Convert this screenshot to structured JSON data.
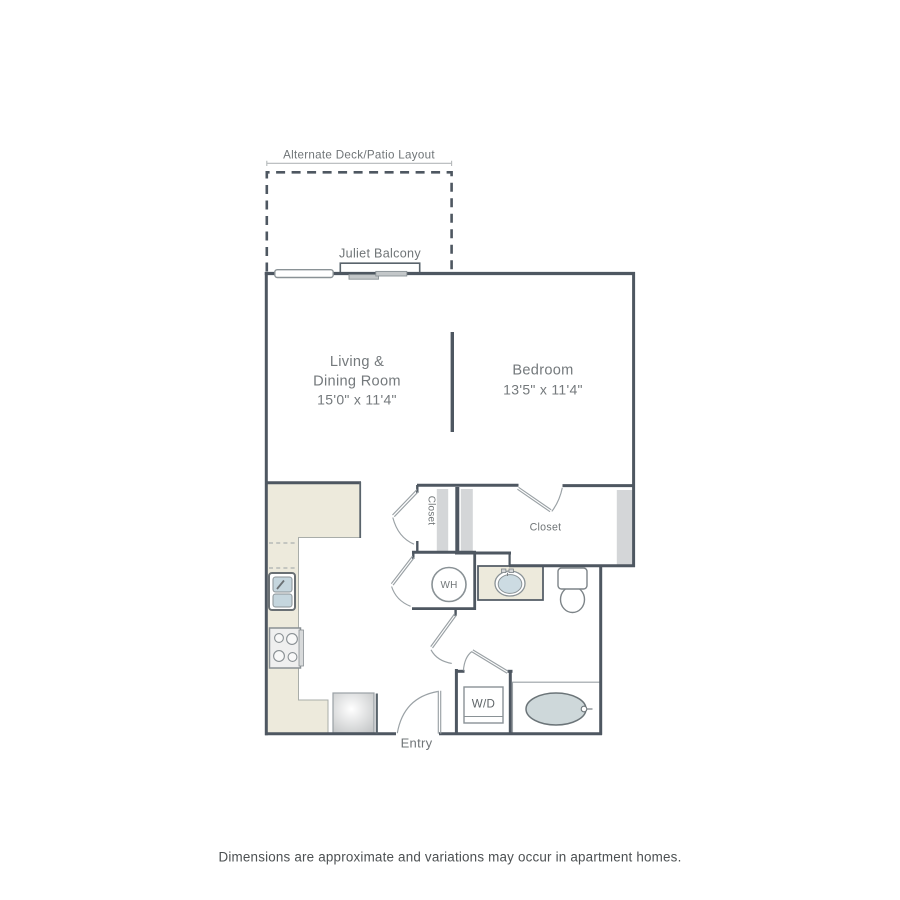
{
  "annotations": {
    "alternate_layout_label": "Alternate Deck/Patio Layout",
    "juliet_balcony_label": "Juliet Balcony",
    "entry_label": "Entry"
  },
  "rooms": {
    "living": {
      "line1": "Living &",
      "line2": "Dining Room",
      "dims": "15'0\" x 11'4\""
    },
    "bedroom": {
      "name": "Bedroom",
      "dims": "13'5\" x 11'4\""
    },
    "hall_closet": {
      "label": "Closet"
    },
    "bedroom_closet": {
      "label": "Closet"
    }
  },
  "fixtures": {
    "water_heater_label": "WH",
    "washer_dryer_label": "W/D"
  },
  "footer": {
    "disclaimer": "Dimensions are approximate and variations may occur in apartment homes."
  },
  "colors": {
    "wall": "#4e5761",
    "fixture_outline": "#9aa1a5",
    "counter_fill": "#edeadc",
    "wall_fill": "#d4d6d8",
    "sink_water_fill": "#ccdbe2",
    "tub_fill": "#ced8da",
    "label_text": "#74797c",
    "footer_text": "#4c5052"
  }
}
